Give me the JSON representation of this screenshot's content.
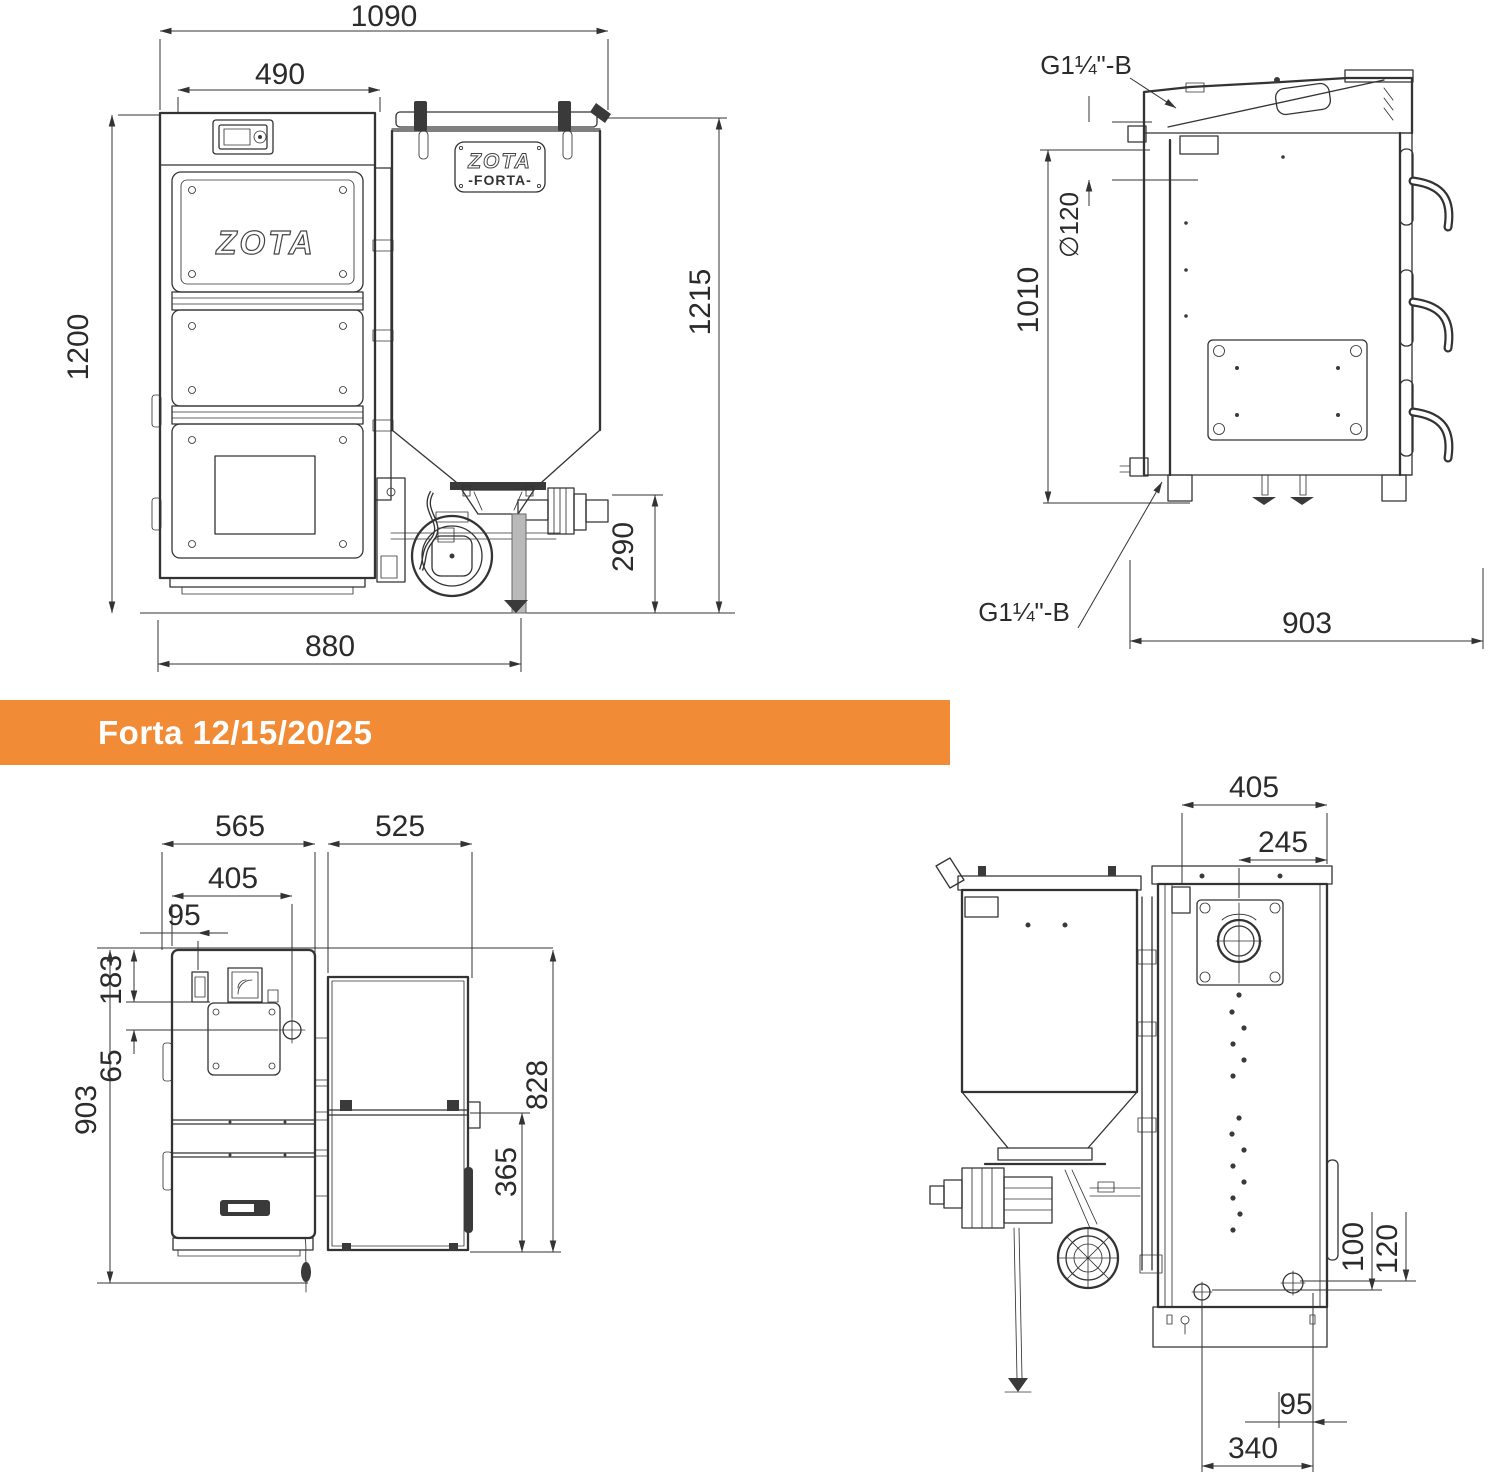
{
  "banner": {
    "label": "Forta 12/15/20/25"
  },
  "colors": {
    "banner_bg": "#F28B36",
    "line": "#333333",
    "text": "#2b2b2b",
    "duct": "#b9b9b9",
    "bg": "#ffffff"
  },
  "brand": {
    "door_logo": "ZOTA",
    "hopper_logo": "ZOTA",
    "hopper_model": "-FORTA-"
  },
  "views": {
    "front": {
      "dims": {
        "total_width": "1090",
        "boiler_width": "490",
        "height_left": "1200",
        "height_right": "1215",
        "burner_height": "290",
        "base_width": "880"
      }
    },
    "side": {
      "dims": {
        "top_connection": "G1¼\"-B",
        "flue_diameter": "∅120",
        "connection_height": "1010",
        "bottom_connection": "G1¼\"-B",
        "depth": "903"
      }
    },
    "top": {
      "dims": {
        "boiler_depth": "565",
        "hopper_depth": "525",
        "flue_offset": "405",
        "chimney_offset": "95",
        "panel_offset": "183",
        "flue_edge_offset": "65",
        "total_depth": "903",
        "hopper_total": "828",
        "hopper_lid": "365"
      }
    },
    "rear": {
      "dims": {
        "hopper_width": "405",
        "flue_offset": "245",
        "bolt_height_a": "100",
        "bolt_height_b": "120",
        "bolt_spacing": "95",
        "bolt_span": "340"
      }
    }
  }
}
